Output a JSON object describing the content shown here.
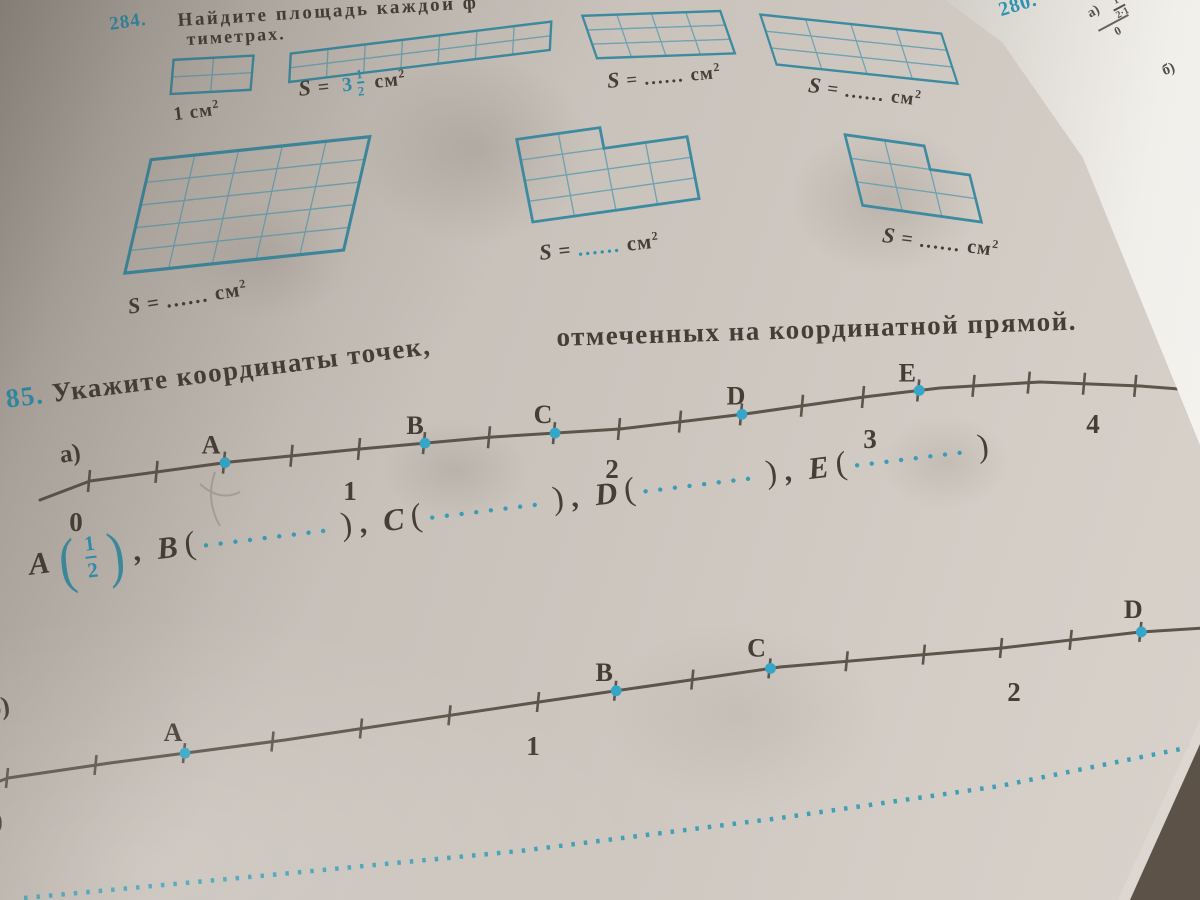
{
  "colors": {
    "ink": "#463d34",
    "teal": "#2e93b2",
    "line": "#5d544a",
    "point_dot": "#35a6c8",
    "grid_outer": "#3c8ba1",
    "grid_inner": "#6fa3b1",
    "paper": "#ccc5be"
  },
  "exercise284": {
    "number": "284.",
    "title_fragment": "Найдите площадь каждой ф",
    "title_fragment2": "тиметрах.",
    "figures": {
      "f1": {
        "type": "rect",
        "cols": 2,
        "rows": 2
      },
      "f2": {
        "type": "rect",
        "cols": 7,
        "rows": 2
      },
      "f3": {
        "type": "rect",
        "cols": 4,
        "rows": 3
      },
      "f4": {
        "type": "rect",
        "cols": 4,
        "rows": 3
      },
      "f5": {
        "type": "rect",
        "cols": 5,
        "rows": 5
      },
      "f6": {
        "type": "poly",
        "cols": 4,
        "rows": 4,
        "cells": [
          [
            0,
            0
          ],
          [
            1,
            0
          ],
          [
            0,
            1
          ],
          [
            1,
            1
          ],
          [
            2,
            1
          ],
          [
            3,
            1
          ],
          [
            0,
            2
          ],
          [
            1,
            2
          ],
          [
            2,
            2
          ],
          [
            3,
            2
          ],
          [
            0,
            3
          ],
          [
            1,
            3
          ],
          [
            2,
            3
          ],
          [
            3,
            3
          ]
        ],
        "outline": [
          [
            0,
            0
          ],
          [
            2,
            0
          ],
          [
            2,
            1
          ],
          [
            4,
            1
          ],
          [
            4,
            4
          ],
          [
            0,
            4
          ]
        ]
      },
      "f7": {
        "type": "poly",
        "cols": 3,
        "rows": 3,
        "cells": [
          [
            0,
            0
          ],
          [
            1,
            0
          ],
          [
            0,
            1
          ],
          [
            1,
            1
          ],
          [
            2,
            1
          ],
          [
            0,
            2
          ],
          [
            1,
            2
          ],
          [
            2,
            2
          ]
        ],
        "outline": [
          [
            0,
            0
          ],
          [
            2,
            0
          ],
          [
            2,
            1
          ],
          [
            3,
            1
          ],
          [
            3,
            3
          ],
          [
            0,
            3
          ]
        ]
      }
    },
    "label1": {
      "value": "1",
      "unit": "см",
      "sup": "2"
    },
    "label2": {
      "s": "S",
      "eq": "=",
      "whole": "3",
      "num": "1",
      "den": "2",
      "unit": "см",
      "sup": "2"
    },
    "label_blank": {
      "s": "S",
      "eq": "=",
      "dots": "......",
      "unit": "см",
      "sup": "2"
    }
  },
  "exercise285": {
    "number": "85.",
    "title_part1": "Укажите координаты точек,",
    "title_part2": "отмеченных на координатной прямой.",
    "part_a_label": "а)",
    "part_b_label": "б)",
    "line_a": {
      "tick_step": "1/4",
      "numbers": [
        {
          "value": 0,
          "label": "0"
        },
        {
          "value": 1,
          "label": "1"
        },
        {
          "value": 2,
          "label": "2"
        },
        {
          "value": 3,
          "label": "3"
        },
        {
          "value": 4,
          "label": "4"
        }
      ],
      "points": [
        {
          "label": "A",
          "value": 0.5
        },
        {
          "label": "B",
          "value": 1.25
        },
        {
          "label": "C",
          "value": 1.75
        },
        {
          "label": "D",
          "value": 2.5
        },
        {
          "label": "E",
          "value": 3.25
        }
      ]
    },
    "line_b": {
      "tick_step": "1/6",
      "numbers": [
        {
          "value": 0,
          "label": "0"
        },
        {
          "value": 1,
          "label": "1"
        },
        {
          "value": 2,
          "label": "2"
        }
      ],
      "points": [
        {
          "label": "A",
          "value": 0.3333
        },
        {
          "label": "B",
          "value": 1.1667
        },
        {
          "label": "C",
          "value": 1.5
        },
        {
          "label": "D",
          "value": 2.3333
        }
      ]
    },
    "answer": {
      "a_label": "A",
      "a_num": "1",
      "a_den": "2",
      "a_sep": ",",
      "items": [
        {
          "label": "B",
          "dots": ".........",
          "sep": ","
        },
        {
          "label": "C",
          "dots": "........",
          "sep": ","
        },
        {
          "label": "D",
          "dots": "........",
          "sep": ","
        },
        {
          "label": "E",
          "dots": "........",
          "sep": ""
        }
      ]
    }
  },
  "facing_page": {
    "number": "280.",
    "item_a": "а)",
    "frac_num": "1",
    "frac_den": "2·1",
    "zero": "0",
    "item_b": "б)"
  }
}
